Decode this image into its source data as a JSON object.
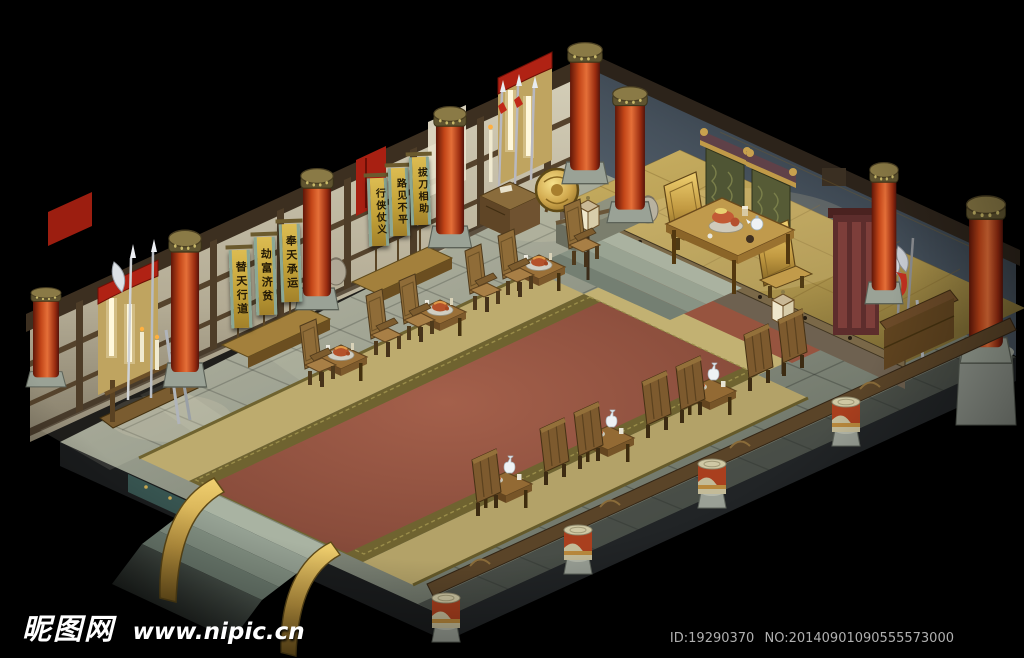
{
  "watermark": {
    "site_name": "昵图网",
    "site_url": "www.nipic.cn",
    "id_label": "ID:19290370",
    "no_label": "NO:20140901090555573000"
  },
  "banners": {
    "left": [
      {
        "text": "替天行道"
      },
      {
        "text": "劫富济贫"
      },
      {
        "text": "奉天承运"
      }
    ],
    "right": [
      {
        "text": "行侠仗义"
      },
      {
        "text": "路见不平"
      },
      {
        "text": "拔刀相助"
      }
    ]
  },
  "palette": {
    "background": "#000000",
    "stone_light": "#b4b8a6",
    "stone_mid": "#8b9083",
    "stone_dark": "#565c54",
    "rim_dark": "#1f2224",
    "carpet_red": "#96543f",
    "carpet_border": "#6f6330",
    "floor_tan": "#c2b172",
    "dais_gold": "#c0a45c",
    "wall_plaster": "#ddd6c2",
    "wood_beam": "#42331f",
    "pillar_red": "#c04a22",
    "bronze": "#8a7a46",
    "banner_yellow": "#c9a83c",
    "banner_teal": "#8aa795",
    "banner_text": "#241a06",
    "curtain_red": "#bf2718",
    "tapestry_green": "#565b36",
    "throne_gold": "#c29b4a",
    "chair_wood": "#96713c",
    "wall_blue": "#55626f",
    "bollard_red": "#b04424",
    "lantern_cream": "#efe7cc",
    "watermark_white": "#ffffff",
    "id_text": "#b0b0b0"
  }
}
